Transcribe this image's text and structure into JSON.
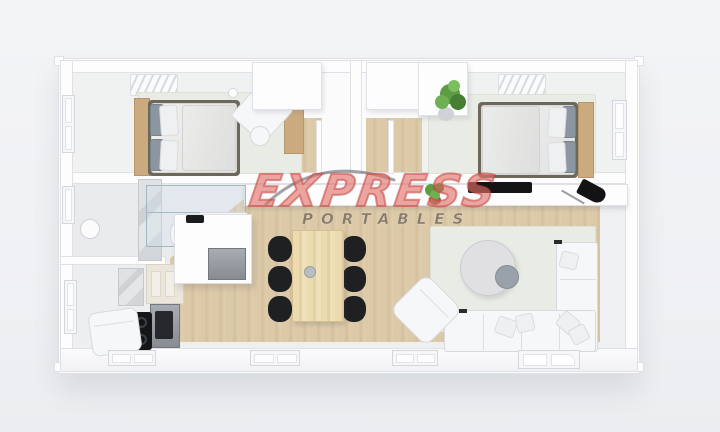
{
  "brand": {
    "name": "EXPRESS",
    "tagline": "PORTABLES"
  },
  "colors": {
    "background": "#f1f2f4",
    "wall_white": "#fdfdfe",
    "wood_floor": "#dcc9a8",
    "bedroom_floor": "#f0f1f1",
    "rug_green_gray": "#e9ece5",
    "wood_accent": "#cbaa7f",
    "chair_black": "#1f2022",
    "appliance_steel": "#8e9399",
    "logo_red": "#eb8078",
    "logo_red_outline": "#c4463e",
    "logo_taupe": "#78685a",
    "plant_green": "#5d9c43"
  },
  "scene": {
    "type": "3d-floor-plan-top-down-render",
    "subject": "two-bedroom portable home / container home",
    "rooms": [
      {
        "name": "bedroom-left",
        "furniture": [
          "ceiling-vent",
          "window",
          "double-bed",
          "gray-pillows",
          "white-pillows",
          "wood-headboard-shelf",
          "rug",
          "rotated-desk",
          "desk-chair",
          "wood-sideboard"
        ]
      },
      {
        "name": "closet-hallway",
        "furniture": [
          "closet-left",
          "closet-right",
          "divider-wall",
          "sliding-door-left",
          "sliding-door-right",
          "wood-hall-floors"
        ]
      },
      {
        "name": "bedroom-right",
        "furniture": [
          "ceiling-vent",
          "window",
          "double-bed",
          "gray-pillows",
          "white-pillows",
          "wood-headboard-shelf",
          "rug",
          "wardrobe",
          "potted-plant"
        ]
      },
      {
        "name": "bathroom",
        "furniture": [
          "window",
          "glass-shower",
          "marble-wall-panel",
          "round-basin",
          "toilet",
          "vanity-counter"
        ]
      },
      {
        "name": "kitchen",
        "furniture": [
          "window",
          "marble-splashback",
          "upper-cabinets",
          "oven",
          "black-cooktop",
          "fridge-cabinet-unit",
          "corner-armchair"
        ]
      },
      {
        "name": "dining-area",
        "furniture": [
          "wood-dining-table",
          "black-chairs-x6",
          "table-centerpiece"
        ]
      },
      {
        "name": "living-room",
        "furniture": [
          "area-rug",
          "round-coffee-table",
          "nesting-side-table",
          "l-shaped-sofa",
          "throw-pillows",
          "rotated-armchair",
          "long-sideboard",
          "tv-black",
          "small-plant",
          "black-desk-lamp"
        ]
      }
    ],
    "openings": [
      "left-window-bedroom",
      "left-window-bathroom",
      "left-window-kitchen",
      "right-window-bedroom",
      "bottom-window-1",
      "bottom-window-2",
      "bottom-window-3",
      "bottom-glass-door"
    ]
  }
}
